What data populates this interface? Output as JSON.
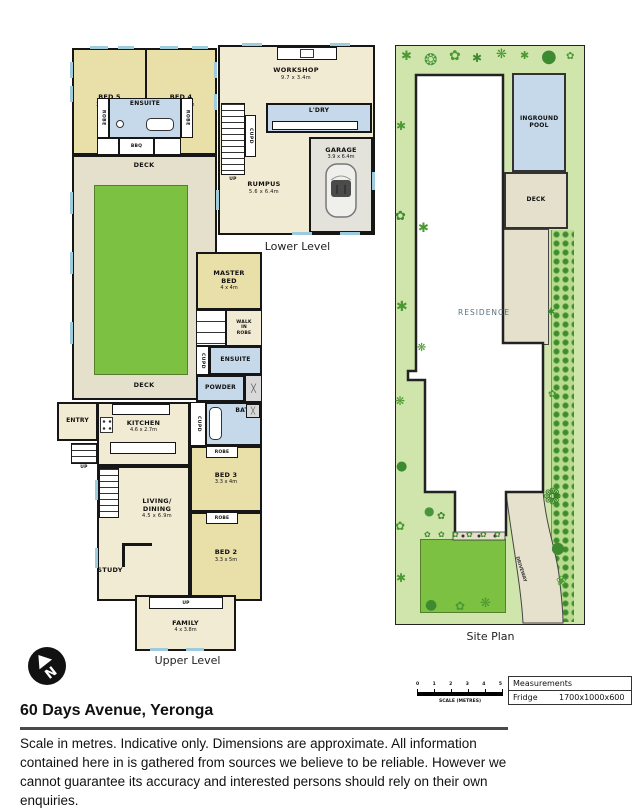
{
  "title": "60 Days Avenue, Yeronga",
  "disclaimer": "Scale in metres. Indicative only. Dimensions are approximate. All information contained here in is gathered from sources we believe to be reliable. However we cannot guarantee its accuracy and interested persons should rely on their own enquiries.",
  "captions": {
    "lower": "Lower Level",
    "upper": "Upper Level",
    "site": "Site Plan"
  },
  "rooms": {
    "bed5": {
      "label": "BED 5",
      "dims": "3.5 x 3.2m"
    },
    "bed4": {
      "label": "BED 4",
      "dims": "3.5 x 3.2m"
    },
    "ensuite_top": {
      "label": "ENSUITE"
    },
    "bbq": {
      "label": "BBQ"
    },
    "deck": {
      "label": "DECK"
    },
    "master": {
      "label": "MASTER BED",
      "dims": "4 x 4m"
    },
    "wir": {
      "label": "WALK IN ROBE"
    },
    "ensuite": {
      "label": "ENSUITE"
    },
    "powder": {
      "label": "POWDER"
    },
    "entry": {
      "label": "ENTRY"
    },
    "kitchen": {
      "label": "KITCHEN",
      "dims": "4.6 x 2.7m"
    },
    "living": {
      "label": "LIVING/ DINING",
      "dims": "4.5 x 6.9m"
    },
    "study": {
      "label": "STUDY"
    },
    "bath": {
      "label": "BATH"
    },
    "bed3": {
      "label": "BED 3",
      "dims": "3.3 x 4m"
    },
    "bed2": {
      "label": "BED 2",
      "dims": "3.3 x 5m"
    },
    "family": {
      "label": "FAMILY",
      "dims": "4 x 3.8m"
    },
    "workshop": {
      "label": "WORKSHOP",
      "dims": "9.7 x 3.4m"
    },
    "ldry": {
      "label": "L'DRY"
    },
    "garage": {
      "label": "GARAGE",
      "dims": "3.9 x 6.4m"
    },
    "rumpus": {
      "label": "RUMPUS",
      "dims": "5.6 x 6.4m"
    },
    "pool": {
      "label": "INGROUND POOL"
    },
    "site_deck": {
      "label": "DECK"
    },
    "residence": {
      "label": "RESIDENCE"
    },
    "driveway": {
      "label": "DRIVEWAY"
    }
  },
  "labels": {
    "up": "UP",
    "cupd": "CUPD",
    "robe": "ROBE"
  },
  "compass": {
    "letter": "N"
  },
  "scalebar": {
    "ticks": [
      "0",
      "1",
      "2",
      "3",
      "4",
      "5"
    ],
    "caption": "SCALE (METRES)"
  },
  "measurements": {
    "header": "Measurements",
    "item": "Fridge",
    "size": "1700x1000x600"
  },
  "icons": {
    "plant_star": "✱",
    "plant_fleur": "❋",
    "plant_bloom": "✿",
    "plant_flower": "❀",
    "plant_big": "❁",
    "bush": "●",
    "tree": "❂",
    "shower_x": "╳"
  },
  "colors": {
    "wall": "#161616",
    "room_cream": "#F2EBD3",
    "room_tan": "#E9DFA9",
    "wet_blue": "#C5D9EA",
    "deck": "#E4E0CC",
    "lawn": "#7CC142",
    "garden": "#CFE5AB",
    "plant_green": "#4C9934",
    "window_blue": "#9ECBDD"
  }
}
